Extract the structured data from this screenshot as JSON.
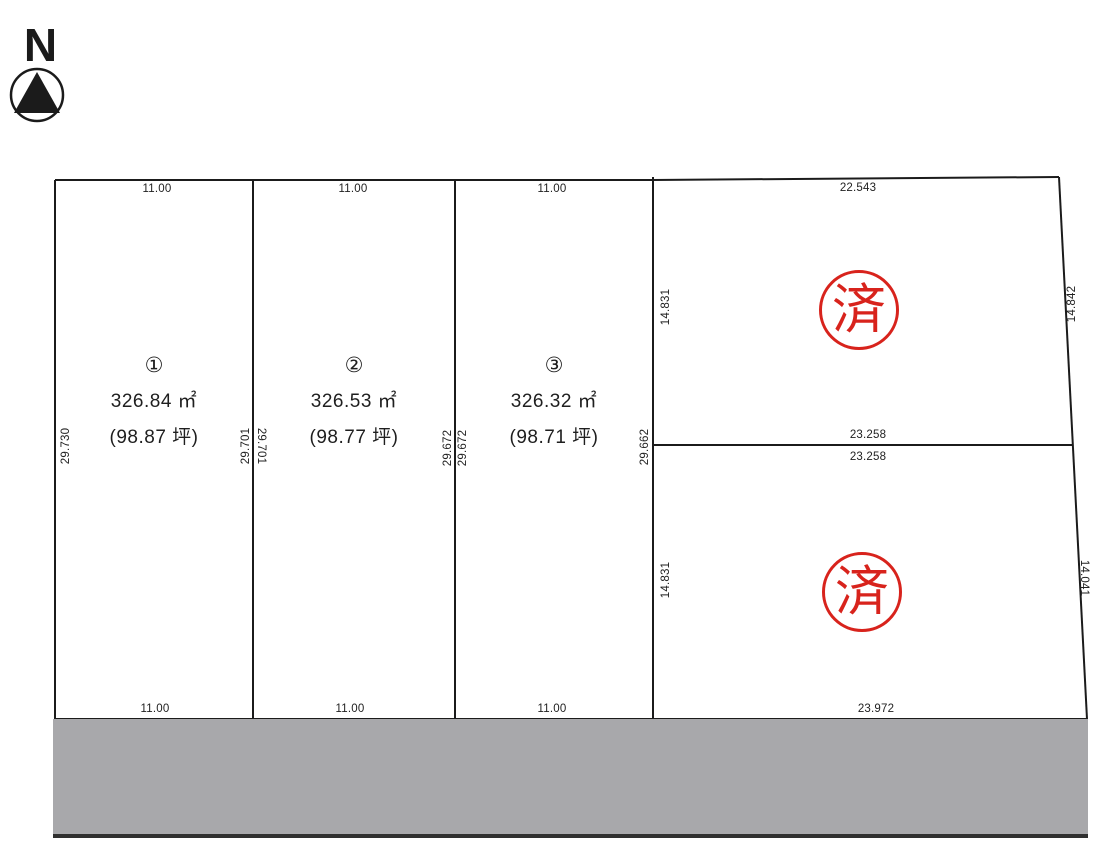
{
  "compass": {
    "label": "N"
  },
  "plots": [
    {
      "number": "①",
      "area_m2": "326.84 ㎡",
      "area_tsubo": "(98.87 坪)"
    },
    {
      "number": "②",
      "area_m2": "326.53 ㎡",
      "area_tsubo": "(98.77 坪)"
    },
    {
      "number": "③",
      "area_m2": "326.32 ㎡",
      "area_tsubo": "(98.71 坪)"
    }
  ],
  "dims": {
    "top": [
      "11.00",
      "11.00",
      "11.00",
      "22.543"
    ],
    "bottom": [
      "11.00",
      "11.00",
      "11.00",
      "23.972"
    ],
    "mid_upper": "23.258",
    "mid_lower": "23.258",
    "left_edge": "29.730",
    "div1_left": "29.701",
    "div1_right": "29.701",
    "div2_left": "29.672",
    "div2_right": "29.672",
    "div3": "29.662",
    "sub_left_upper": "14.831",
    "sub_left_lower": "14.831",
    "right_upper": "14.842",
    "right_lower": "14.041"
  },
  "stamps": {
    "label": "済",
    "color": "#d8231c"
  },
  "road": {
    "fill": "#a8a8ab"
  },
  "colors": {
    "line": "#1b1b1b",
    "text": "#1f1f1f"
  }
}
